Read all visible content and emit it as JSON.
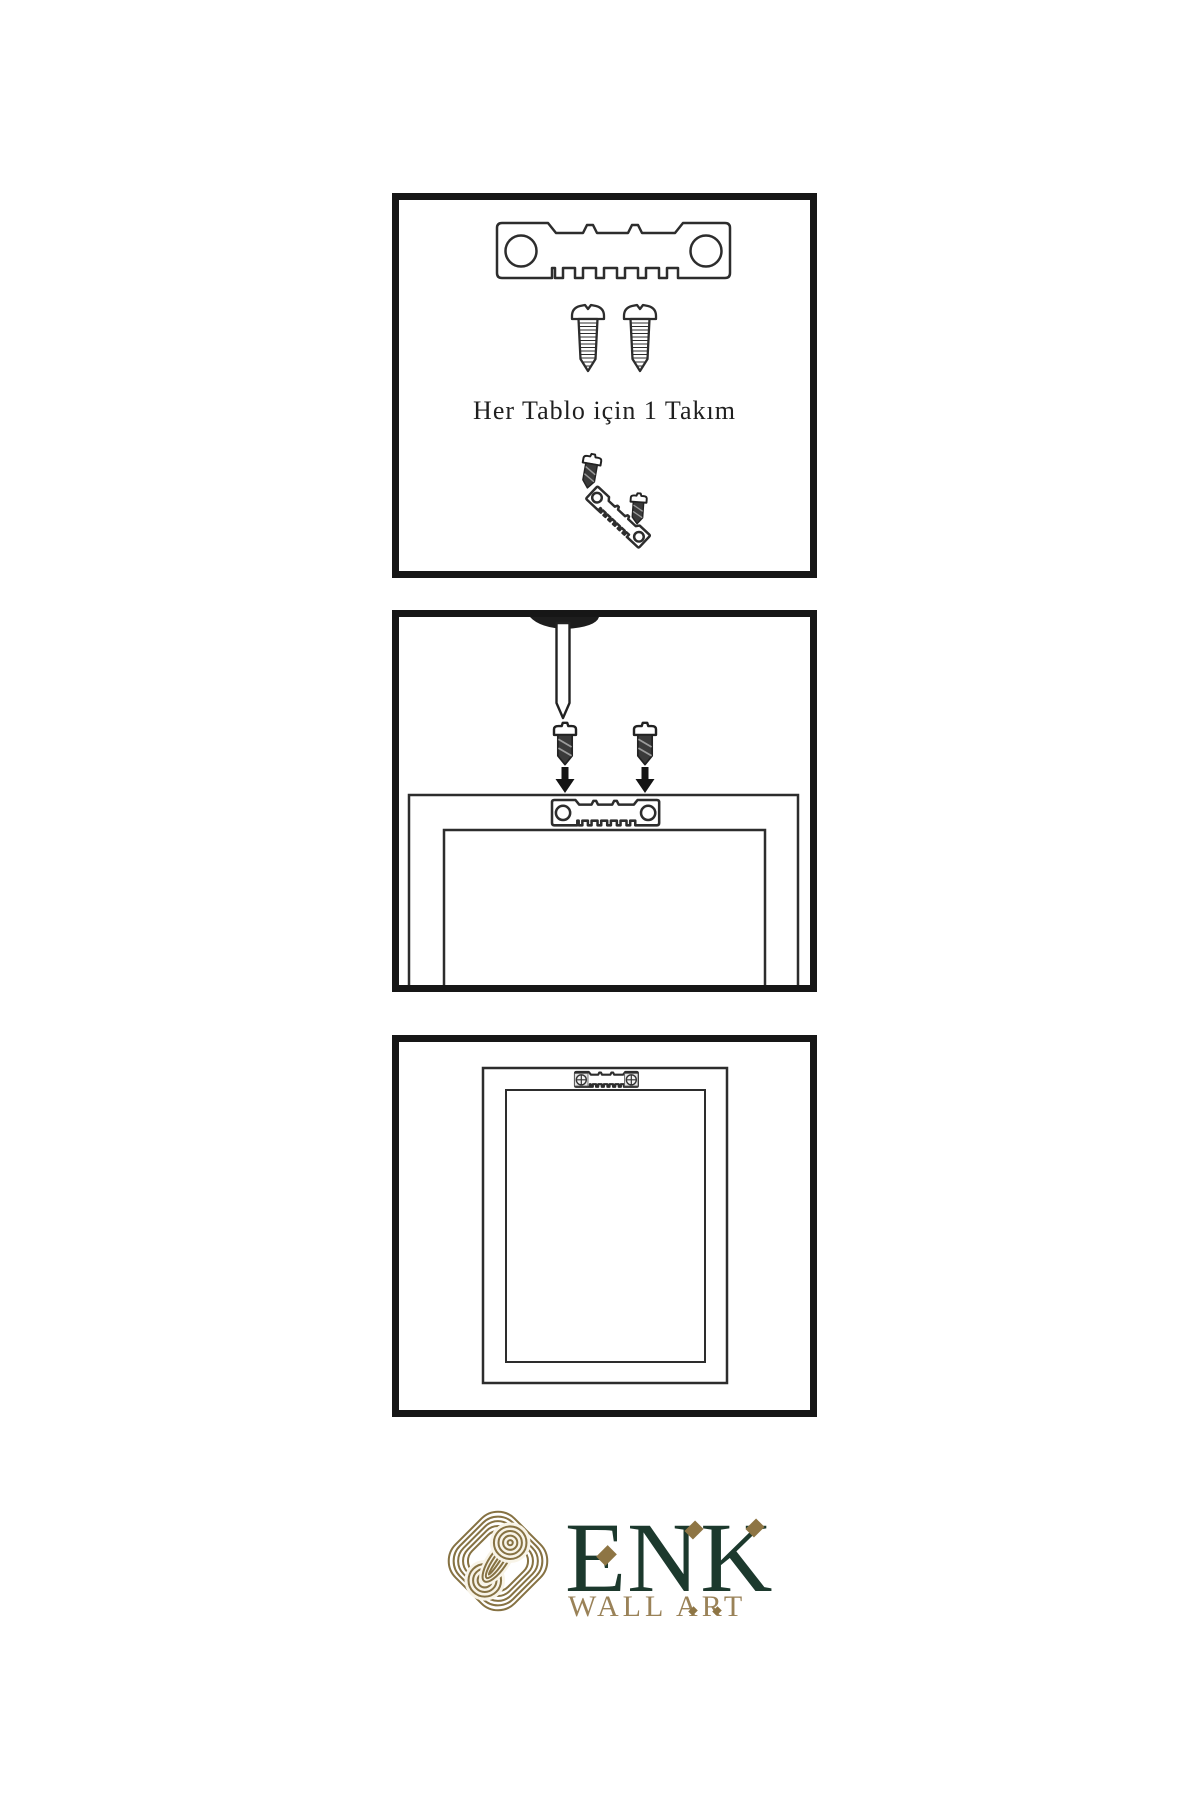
{
  "canvas": {
    "background": "#ffffff"
  },
  "instructions": {
    "steps": [
      {
        "name": "hardware-kit",
        "caption": "Her Tablo için 1 Takım",
        "icons": [
          "sawtooth-hanger-icon",
          "screw-icon",
          "screw-icon",
          "screw-into-tilted-hanger-icon"
        ]
      },
      {
        "name": "attach-hanger-to-frame",
        "icons": [
          "nail-icon",
          "dark-screw-icon",
          "dark-screw-icon",
          "down-arrow-icon",
          "down-arrow-icon",
          "frame-back-icon",
          "sawtooth-hanger-icon"
        ]
      },
      {
        "name": "frame-mounted",
        "icons": [
          "frame-back-icon",
          "installed-sawtooth-hanger-icon",
          "phillips-screw-icon",
          "phillips-screw-icon"
        ]
      }
    ]
  },
  "brand": {
    "logo_icon": "interlaced-knot-icon",
    "wordmark": "ENK",
    "tagline": "WALL ART",
    "colors": {
      "green": "#1c392d",
      "gold": "#8e7544",
      "tagline_gold": "#9a8258",
      "line_art": "#2d2d2d",
      "panel_border": "#161616"
    }
  }
}
